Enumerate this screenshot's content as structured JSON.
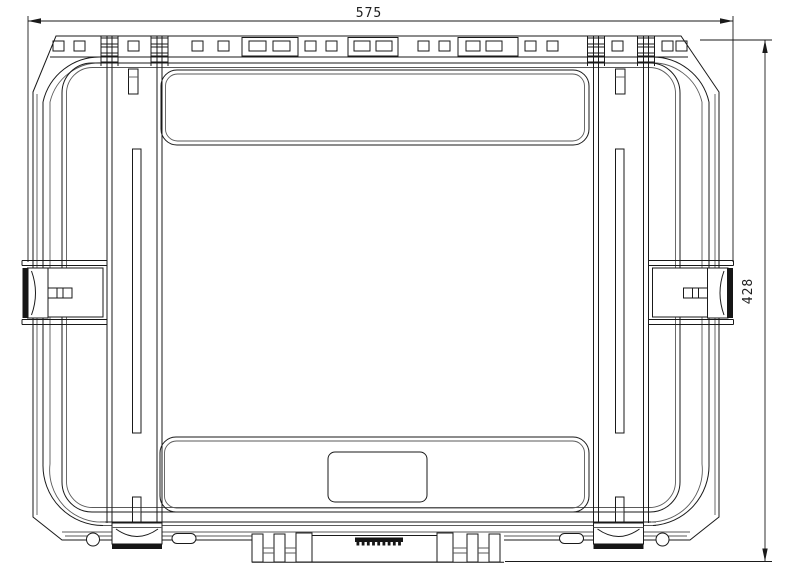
{
  "drawing": {
    "view_label": "protective-case-top-view",
    "dimensions": {
      "width": {
        "value": "575",
        "orientation": "horizontal",
        "position": "top"
      },
      "height": {
        "value": "428",
        "orientation": "vertical",
        "position": "right"
      }
    },
    "style": {
      "line_color": "#1a1a1a",
      "background": "#ffffff",
      "latch_fill": "#161616"
    }
  }
}
